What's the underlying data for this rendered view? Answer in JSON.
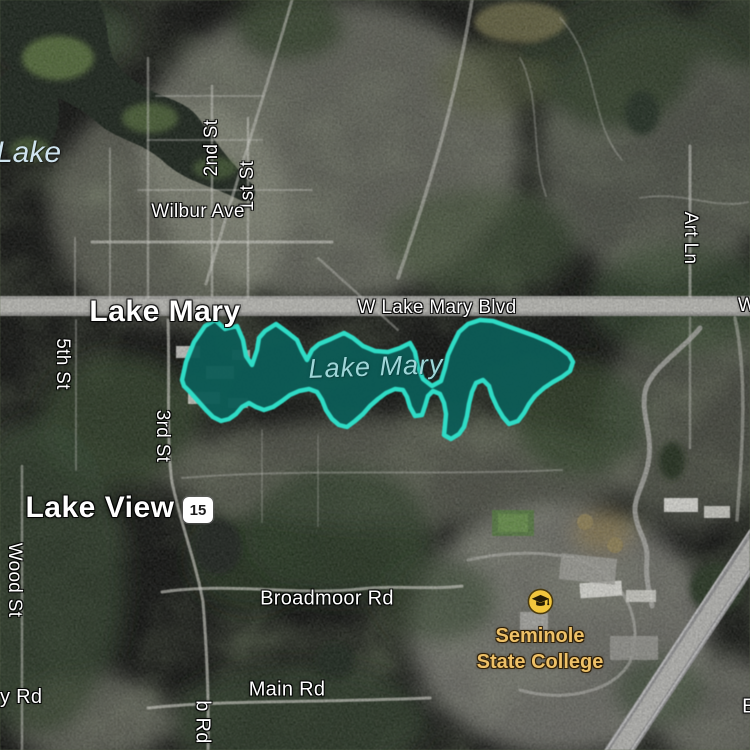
{
  "map": {
    "view": "satellite",
    "selected_feature": {
      "name": "Lake Mary",
      "kind": "lake",
      "outline_color": "#2fdcc6",
      "fill_color": "#0d5c56"
    },
    "place_labels": {
      "lake_partial": "Lake",
      "city_lake_mary": "Lake Mary",
      "city_lake_view": "Lake View",
      "water_lake_mary": "Lake Mary"
    },
    "poi": {
      "line1": "Seminole",
      "line2": "State College",
      "icon": "graduation-cap-icon",
      "label_color": "#eec168"
    },
    "route_shield": {
      "number": "15"
    },
    "road_labels": {
      "wilbur_ave": "Wilbur Ave",
      "w_lake_mary_blvd": "W Lake Mary Blvd",
      "w_partial": "W",
      "second_st": "2nd St",
      "first_st": "1st St",
      "fifth_st": "5th St",
      "third_st": "3rd St",
      "art_ln": "Art Ln",
      "wood_st": "Wood St",
      "broadmoor_rd": "Broadmoor Rd",
      "main_rd": "Main Rd",
      "y_rd_partial": "y Rd",
      "b_rd_partial": "b Rd",
      "e_partial": "E"
    }
  }
}
